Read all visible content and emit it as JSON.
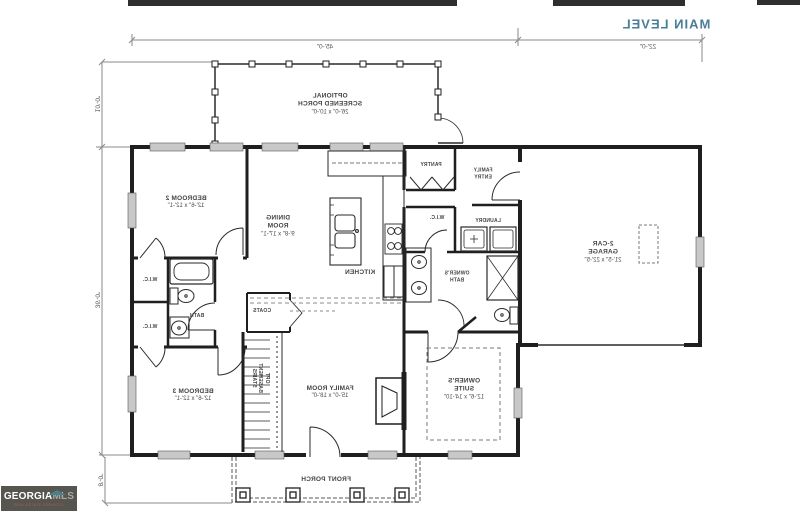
{
  "title": "MAIN LEVEL",
  "colors": {
    "title": "#4a7d96",
    "plan_line": "#1f1f1f",
    "dimension": "#8a8a8a",
    "logo_bg": "#57554f",
    "logo_roof": "#49808c",
    "logo_tagline": "#b06048"
  },
  "note": "floor plan image is horizontally mirrored",
  "dimensions": {
    "top_main": "45'-0\"",
    "top_garage": "22'-0\"",
    "left_screened_porch": "10'-0\"",
    "left_main": "36'-0\"",
    "left_front_porch": "8'-0\""
  },
  "rooms": {
    "screened_porch": {
      "l1": "OPTIONAL",
      "l2": "SCREENED PORCH",
      "dims": "26'-0\" x 10'-0\""
    },
    "bedroom2": {
      "name": "BEDROOM 2",
      "dims": "12'-6\" x 12'-1\""
    },
    "dining": {
      "l1": "DINING",
      "l2": "ROOM",
      "dims": "9'-8\" x 17'-1\""
    },
    "kitchen": {
      "name": "KITCHEN"
    },
    "pantry": {
      "name": "PANTRY"
    },
    "family_entry": {
      "l1": "FAMILY",
      "l2": "ENTRY"
    },
    "wic_owners": {
      "name": "W.I.C."
    },
    "laundry": {
      "name": "LAUNDRY"
    },
    "owners_bath": {
      "l1": "OWNER'S",
      "l2": "BATH"
    },
    "garage": {
      "l1": "2-CAR",
      "l2": "GARAGE",
      "dims": "21'-5\" x 22'-5\""
    },
    "owners_suite": {
      "l1": "OWNER'S",
      "l2": "SUITE",
      "dims": "12'-6\" x 14'-10\""
    },
    "family_room": {
      "name": "FAMILY ROOM",
      "dims": "15'-0\" x 18'-0\""
    },
    "hall_bath": {
      "name": "BATH"
    },
    "wic_upper": {
      "name": "W.I.C."
    },
    "wic_lower": {
      "name": "W.I.C."
    },
    "coats": {
      "name": "COATS"
    },
    "stairs": {
      "l1": "OPT",
      "l2": "BASEMENT",
      "l3": "STAIRS"
    },
    "bedroom3": {
      "name": "BEDROOM 3",
      "dims": "12'-6\" x 12'-1\""
    },
    "front_porch": {
      "name": "FRONT PORCH"
    }
  },
  "logo": {
    "brand_bold": "GEORGIA",
    "brand_light": "MLS",
    "tagline": "REAL ESTATE SERVICES"
  }
}
